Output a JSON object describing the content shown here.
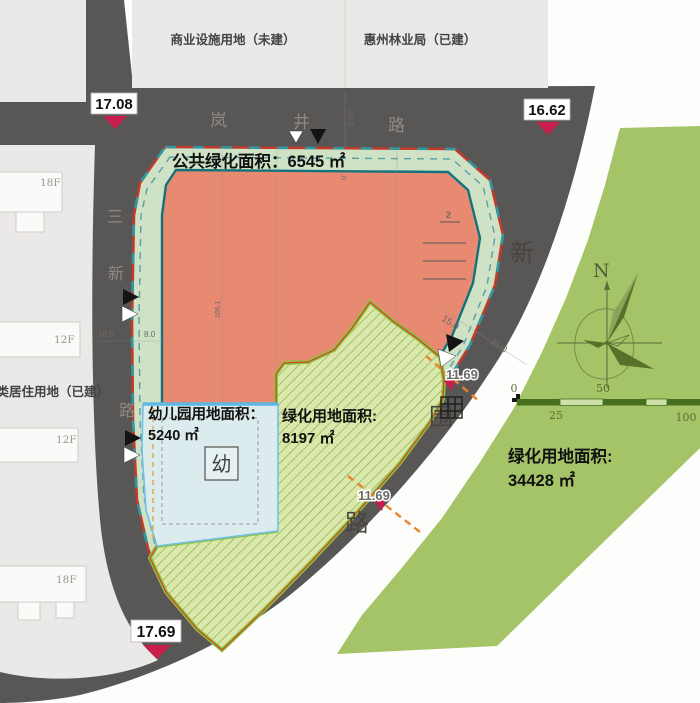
{
  "parcels": {
    "commercial_label": "商业设施用地（未建）",
    "forestry_label": "惠州林业局（已建）",
    "residential_label": "二类居住用地（已建）",
    "building_labels": [
      "18F",
      "12F",
      "12F",
      "18F"
    ]
  },
  "roads": {
    "top_chars": [
      "岚",
      "井",
      "路"
    ],
    "left_chars": [
      "三",
      "新",
      "路"
    ],
    "right_chars": [
      "新",
      "围",
      "路"
    ]
  },
  "elevation_markers": {
    "nw": "17.08",
    "ne": "16.62",
    "sw": "17.69"
  },
  "area_labels": {
    "public_green": "公共绿化面积：6545 ㎡",
    "kindergarten_title": "幼儿园用地面积：",
    "kindergarten_value": "5240 ㎡",
    "site_green_title": "绿化用地面积:",
    "site_green_value": "8197 ㎡",
    "east_green_title": "绿化用地面积:",
    "east_green_value": "34428 ㎡"
  },
  "symbols": {
    "kindergarten": "幼",
    "north": "N"
  },
  "dimensions": {
    "left_offset_a": "18.0",
    "left_offset_b": "8.0",
    "road_width_top": "26.0",
    "band_width": "1.0",
    "curve_a": "15.0",
    "curve_b": "36.0",
    "chainage_a": "11.69",
    "chainage_b": "11.69",
    "interior": "106.1",
    "note": "2"
  },
  "scale_bar": {
    "t0": "0",
    "t25": "25",
    "t50": "50",
    "t100": "100"
  },
  "colors": {
    "road": "#595656",
    "site_fill": "#e88a72",
    "buffer_fill": "#cfe2c5",
    "boundary_red": "#c23a2c",
    "boundary_teal": "#15727c",
    "hatch_fill": "#dbe8ac",
    "hatch_border": "#8cc43e",
    "kindergarten_fill": "#dcecee",
    "kindergarten_border": "#66b8e0",
    "east_green": "#a5c468",
    "marker_red": "#c81e4b",
    "dim_orange": "#e8862e"
  }
}
